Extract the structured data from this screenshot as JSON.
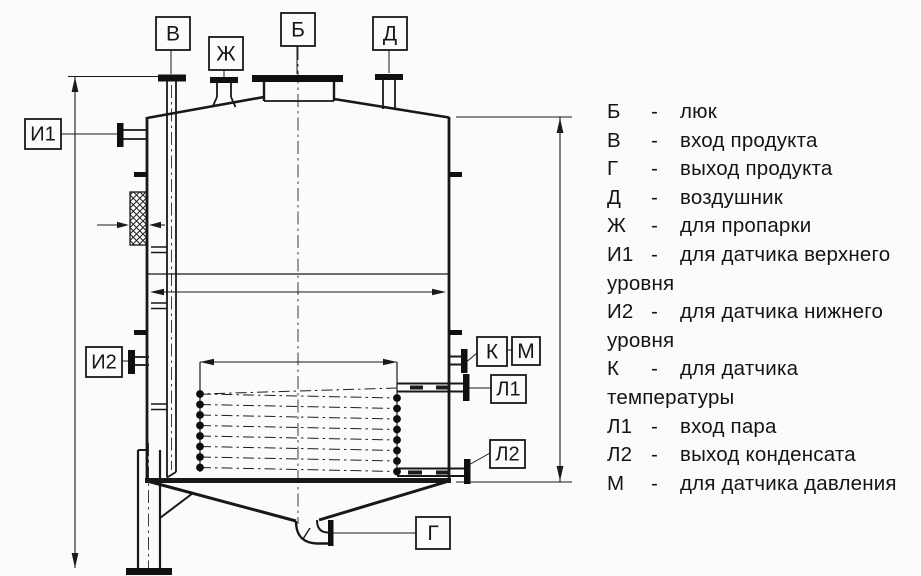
{
  "diagram": {
    "labels": {
      "v": "В",
      "zh": "Ж",
      "b": "Б",
      "d": "Д",
      "i1": "И1",
      "i2": "И2",
      "k": "К",
      "m": "М",
      "l1": "Л1",
      "l2": "Л2",
      "g": "Г"
    }
  },
  "legend": {
    "lines": [
      {
        "key": "Б",
        "sep": "-",
        "text": "люк"
      },
      {
        "key": "В",
        "sep": "-",
        "text": "вход продукта"
      },
      {
        "key": "Г",
        "sep": "-",
        "text": "выход продукта"
      },
      {
        "key": "Д",
        "sep": "-",
        "text": "воздушник"
      },
      {
        "key": "Ж",
        "sep": "-",
        "text": "для пропарки"
      },
      {
        "key": "И1",
        "sep": "-",
        "text": "для датчика верхнего"
      },
      {
        "cont": "уровня"
      },
      {
        "key": "И2",
        "sep": "-",
        "text": "для датчика нижнего"
      },
      {
        "cont": "уровня"
      },
      {
        "key": "К",
        "sep": "-",
        "text": "для датчика"
      },
      {
        "cont": "температуры"
      },
      {
        "key": "Л1",
        "sep": "-",
        "text": "вход пара"
      },
      {
        "key": "Л2",
        "sep": "-",
        "text": "выход конденсата"
      },
      {
        "key": "М",
        "sep": "-",
        "text": "для датчика давления"
      }
    ]
  },
  "colors": {
    "ink": "#1a1a1a",
    "paper": "#fbfbf9"
  }
}
